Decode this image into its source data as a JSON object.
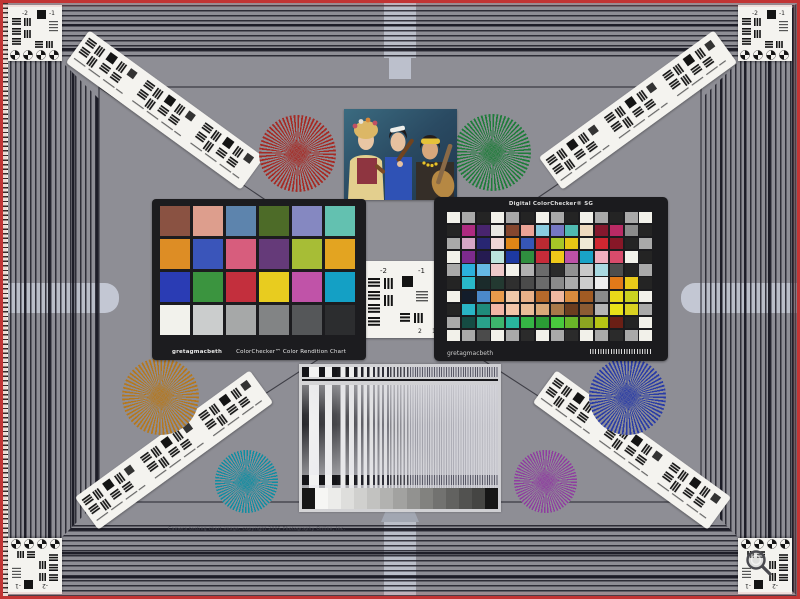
{
  "meta": {
    "description": "Camera evaluation test chart photograph",
    "background_gray": "#8e8e95",
    "border_red": "#c23434"
  },
  "labels": {
    "cc_brand": "gretagmacbeth",
    "cc_title": "ColorChecker™ Color Rendition Chart",
    "sg_title": "Digital ColorChecker® SG",
    "sg_brand": "gretagmacbeth",
    "copyright": "Camera testing chart image, copyright 2005 Photography Online, Inc.",
    "usaf_neg2": "-2",
    "usaf_neg1": "-1",
    "usaf_1": "1",
    "usaf_2": "2"
  },
  "colorchecker": {
    "patches": [
      [
        "#8a5242",
        "#dd9e8d",
        "#5d84ad",
        "#4d6b28",
        "#8588c1",
        "#63c1b0"
      ],
      [
        "#dd8d25",
        "#3a55ba",
        "#d75d7d",
        "#653a79",
        "#a7bd36",
        "#e3a421"
      ],
      [
        "#2a3cb4",
        "#3b943f",
        "#c32f3d",
        "#e8cc1f",
        "#c053a8",
        "#14a0c5"
      ],
      [
        "#f2f2ec",
        "#cbcdcd",
        "#a6a8a8",
        "#828485",
        "#555759",
        "#2c2d2f"
      ]
    ]
  },
  "sg": {
    "patches": [
      [
        "#f2f1ea",
        "#a9a9a9",
        "#242424",
        "#f2f1ea",
        "#a9a9a9",
        "#242424",
        "#f2f1ea",
        "#a9a9a9",
        "#242424",
        "#f2f1ea",
        "#a9a9a9",
        "#242424",
        "#a9a9a9",
        "#f2f1ea"
      ],
      [
        "#242424",
        "#ad2a80",
        "#48246e",
        "#e8e7e1",
        "#85472f",
        "#eba396",
        "#8accdf",
        "#7577c3",
        "#4fbab1",
        "#eedabf",
        "#85182e",
        "#ba2a64",
        "#8b8b8b",
        "#242424"
      ],
      [
        "#a9a9a9",
        "#d6a6c6",
        "#282672",
        "#efd6d5",
        "#df8617",
        "#3656b6",
        "#bd2a32",
        "#a6c627",
        "#e6c615",
        "#efe9d5",
        "#cf2731",
        "#871727",
        "#242424",
        "#a9a9a9"
      ],
      [
        "#f2f1ea",
        "#7d2b8d",
        "#251b51",
        "#bde5dd",
        "#1d39a1",
        "#2f8f3f",
        "#c72b39",
        "#efc919",
        "#bd51a7",
        "#19a3c7",
        "#f1afbf",
        "#d94b6b",
        "#f2f1ea",
        "#242424"
      ],
      [
        "#a9a9a9",
        "#2bb1dd",
        "#65b9e5",
        "#edc9c9",
        "#f2f1ea",
        "#b1b1b1",
        "#6b6b6b",
        "#2b2b2b",
        "#919191",
        "#c9c9c9",
        "#a9d9e1",
        "#4d4d4d",
        "#242424",
        "#a9a9a9"
      ],
      [
        "#242424",
        "#29b9c9",
        "#1b2b2b",
        "#233931",
        "#2f2f2f",
        "#4b4b4b",
        "#6b6b6b",
        "#8b8b8b",
        "#ababab",
        "#cdcdcd",
        "#ededed",
        "#e17919",
        "#e9c919",
        "#242424"
      ],
      [
        "#f2f1ea",
        "#131d2b",
        "#4b89c9",
        "#e99b4b",
        "#f1c9a9",
        "#e9b189",
        "#b5692b",
        "#f1b9a1",
        "#d98b3d",
        "#a15b23",
        "#8b8b8b",
        "#e9d919",
        "#c9d121",
        "#f2f1ea"
      ],
      [
        "#242424",
        "#29b5c5",
        "#1f8b7b",
        "#f1b5a5",
        "#f3c5a9",
        "#e9bd99",
        "#d9a979",
        "#a97949",
        "#6b3d1f",
        "#8b5b33",
        "#b5b5b5",
        "#e9e119",
        "#d9d121",
        "#a9a9a9"
      ],
      [
        "#a9a9a9",
        "#154b43",
        "#29a18b",
        "#3db56d",
        "#29b59d",
        "#35b545",
        "#2b9b35",
        "#49c93d",
        "#69b529",
        "#8ba521",
        "#b5c515",
        "#6b1f15",
        "#242424",
        "#f2f1ea"
      ],
      [
        "#f2f1ea",
        "#a9a9a9",
        "#4b4b4b",
        "#f2f1ea",
        "#a9a9a9",
        "#2b2b2b",
        "#f2f1ea",
        "#a9a9a9",
        "#2b2b2b",
        "#f2f1ea",
        "#a9a9a9",
        "#2b2b2b",
        "#a9a9a9",
        "#f2f1ea"
      ]
    ]
  },
  "stars": {
    "red": "#a62a24",
    "green": "#1f7c3a",
    "orange": "#b5781e",
    "blue": "#2a3ca6",
    "teal": "#0f8da2",
    "purple": "#8f3da0"
  },
  "grayscale": {
    "steps": [
      "#f6f6f4",
      "#ececea",
      "#dededc",
      "#d0d0ce",
      "#c2c2c0",
      "#b2b2b0",
      "#a2a2a0",
      "#929290",
      "#82827f",
      "#727270",
      "#626260",
      "#525250",
      "#454543"
    ]
  }
}
